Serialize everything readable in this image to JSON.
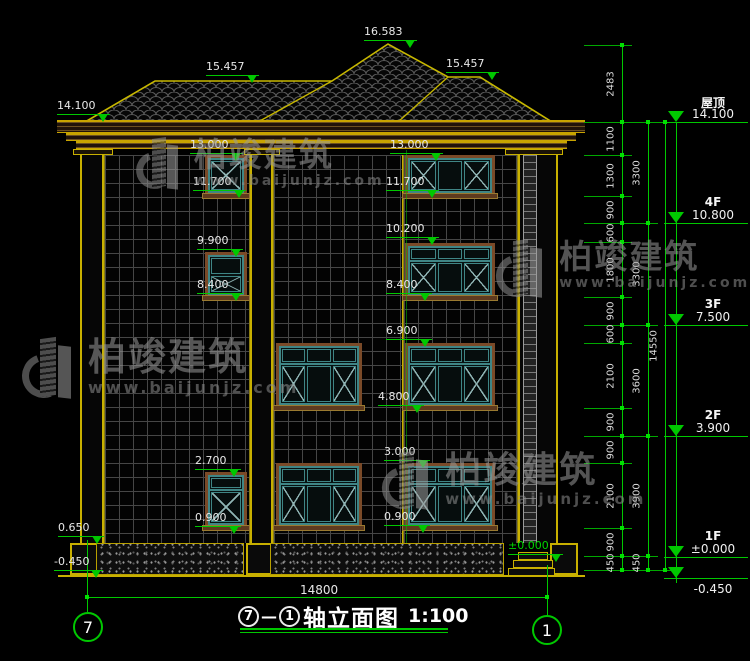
{
  "drawing": {
    "type": "建筑立面图",
    "background": "#000000",
    "accent_green": "#00c800",
    "outline_yellow": "#c8b000",
    "window_teal": "#3f8585"
  },
  "title": {
    "axis_from": "7",
    "dash": "—",
    "axis_to": "1",
    "name": "轴立面图",
    "scale": "1:100"
  },
  "axes": [
    {
      "label": "7",
      "x": 73,
      "y": 612
    },
    {
      "label": "1",
      "x": 532,
      "y": 615
    }
  ],
  "bottom_dim": {
    "value": "14800",
    "x1": 87,
    "x2": 547,
    "y": 597,
    "label_x": 300,
    "label_y": 583
  },
  "watermark": {
    "brand": "柏竣建筑",
    "url": "www.baijunjz.com",
    "instances": [
      {
        "x": 24,
        "y": 338,
        "brand_size": 38,
        "url_size": 16,
        "logo": 1.0
      },
      {
        "x": 138,
        "y": 138,
        "brand_size": 33,
        "url_size": 14,
        "logo": 0.85
      },
      {
        "x": 498,
        "y": 240,
        "brand_size": 33,
        "url_size": 14,
        "logo": 0.95
      },
      {
        "x": 384,
        "y": 452,
        "brand_size": 36,
        "url_size": 15,
        "logo": 0.95
      }
    ]
  },
  "annotations": [
    {
      "t": "16.583",
      "x": 364,
      "y": 26
    },
    {
      "t": "15.457",
      "x": 206,
      "y": 61
    },
    {
      "t": "15.457",
      "x": 446,
      "y": 58
    },
    {
      "t": "14.100",
      "x": 57,
      "y": 100
    },
    {
      "t": "13.000",
      "x": 190,
      "y": 139
    },
    {
      "t": "11.700",
      "x": 193,
      "y": 176
    },
    {
      "t": "9.900",
      "x": 197,
      "y": 235
    },
    {
      "t": "8.400",
      "x": 197,
      "y": 279
    },
    {
      "t": "2.700",
      "x": 195,
      "y": 455
    },
    {
      "t": "0.900",
      "x": 195,
      "y": 512
    },
    {
      "t": "0.650",
      "x": 58,
      "y": 522
    },
    {
      "t": "-0.450",
      "x": 54,
      "y": 556
    },
    {
      "t": "13.000",
      "x": 390,
      "y": 139
    },
    {
      "t": "11.700",
      "x": 386,
      "y": 176
    },
    {
      "t": "10.200",
      "x": 386,
      "y": 223
    },
    {
      "t": "8.400",
      "x": 386,
      "y": 279
    },
    {
      "t": "6.900",
      "x": 386,
      "y": 325
    },
    {
      "t": "4.800",
      "x": 378,
      "y": 391
    },
    {
      "t": "3.000",
      "x": 384,
      "y": 446
    },
    {
      "t": "0.900",
      "x": 384,
      "y": 511
    },
    {
      "t": "±0.000",
      "x": 508,
      "y": 540,
      "cls": "green"
    }
  ],
  "dims": {
    "columns": [
      {
        "x": 622,
        "segs": [
          {
            "v": "2483",
            "y1": 45,
            "y2": 122
          },
          {
            "v": "1100",
            "y1": 122,
            "y2": 155
          },
          {
            "v": "1300",
            "y1": 155,
            "y2": 196
          },
          {
            "v": "900",
            "y1": 196,
            "y2": 223
          },
          {
            "v": "600",
            "y1": 223,
            "y2": 242
          },
          {
            "v": "1800",
            "y1": 242,
            "y2": 297
          },
          {
            "v": "900",
            "y1": 297,
            "y2": 325
          },
          {
            "v": "600",
            "y1": 325,
            "y2": 343
          },
          {
            "v": "2100",
            "y1": 343,
            "y2": 408
          },
          {
            "v": "900",
            "y1": 408,
            "y2": 436
          },
          {
            "v": "900",
            "y1": 436,
            "y2": 463
          },
          {
            "v": "2100",
            "y1": 463,
            "y2": 528
          },
          {
            "v": "900",
            "y1": 528,
            "y2": 556
          },
          {
            "v": "450",
            "y1": 556,
            "y2": 570
          }
        ]
      },
      {
        "x": 648,
        "segs": [
          {
            "v": "3300",
            "y1": 122,
            "y2": 223
          },
          {
            "v": "3300",
            "y1": 223,
            "y2": 325
          },
          {
            "v": "3600",
            "y1": 325,
            "y2": 436
          },
          {
            "v": "3900",
            "y1": 436,
            "y2": 556
          },
          {
            "v": "450",
            "y1": 556,
            "y2": 570
          }
        ]
      },
      {
        "x": 665,
        "segs": [
          {
            "v": "14550",
            "y1": 122,
            "y2": 570
          }
        ]
      }
    ]
  },
  "floors": [
    {
      "name": "屋顶",
      "value": "14.100",
      "y": 122
    },
    {
      "name": "4F",
      "value": "10.800",
      "y": 223
    },
    {
      "name": "3F",
      "value": "7.500",
      "y": 325
    },
    {
      "name": "2F",
      "value": "3.900",
      "y": 436
    },
    {
      "name": "1F",
      "value": "±0.000",
      "y": 557
    },
    {
      "name": "",
      "value": "-0.450",
      "y": 578,
      "below": true
    }
  ],
  "windows": [
    {
      "x": 205,
      "y": 155,
      "w": 42,
      "h": 41,
      "kind": "sm-x"
    },
    {
      "x": 205,
      "y": 252,
      "w": 42,
      "h": 46,
      "kind": "sm-2"
    },
    {
      "x": 205,
      "y": 472,
      "w": 42,
      "h": 56,
      "kind": "sm-tr"
    },
    {
      "x": 276,
      "y": 343,
      "w": 86,
      "h": 65,
      "kind": "big-tr"
    },
    {
      "x": 276,
      "y": 463,
      "w": 86,
      "h": 65,
      "kind": "big-tr"
    },
    {
      "x": 405,
      "y": 155,
      "w": 90,
      "h": 41,
      "kind": "big"
    },
    {
      "x": 405,
      "y": 243,
      "w": 90,
      "h": 55,
      "kind": "big-tr"
    },
    {
      "x": 405,
      "y": 343,
      "w": 90,
      "h": 65,
      "kind": "big-tr"
    },
    {
      "x": 405,
      "y": 463,
      "w": 90,
      "h": 65,
      "kind": "big-tr"
    }
  ]
}
